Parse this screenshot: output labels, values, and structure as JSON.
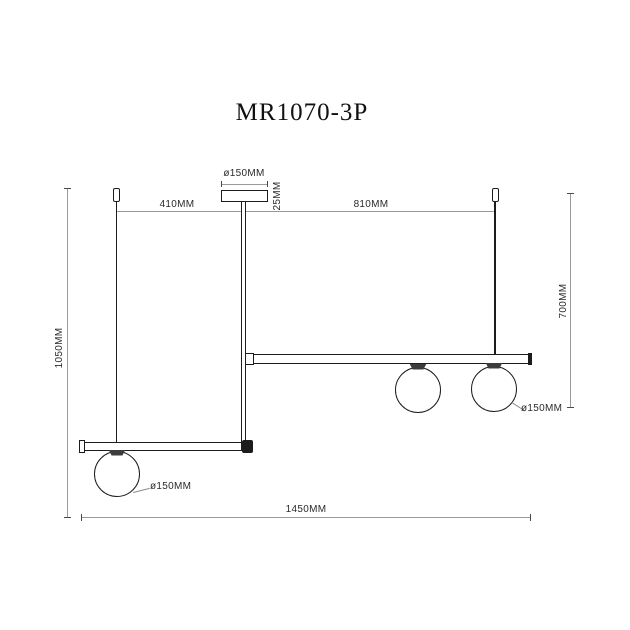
{
  "title": "MR1070-3P",
  "labels": {
    "canopy_diameter": "ø150MM",
    "canopy_height": "25MM",
    "span_left": "410MM",
    "span_right": "810MM",
    "drop_left": "1050MM",
    "drop_right": "700MM",
    "total_length": "1450MM",
    "globe_upper_diameter": "ø150MM",
    "globe_lower_diameter": "ø150MM"
  },
  "colors": {
    "outline": "#1c1c1c",
    "dimension_line": "#9a9a9a",
    "fitting_fill": "#3c3c3c",
    "label_text": "#2b2b2b",
    "background": "#ffffff"
  }
}
